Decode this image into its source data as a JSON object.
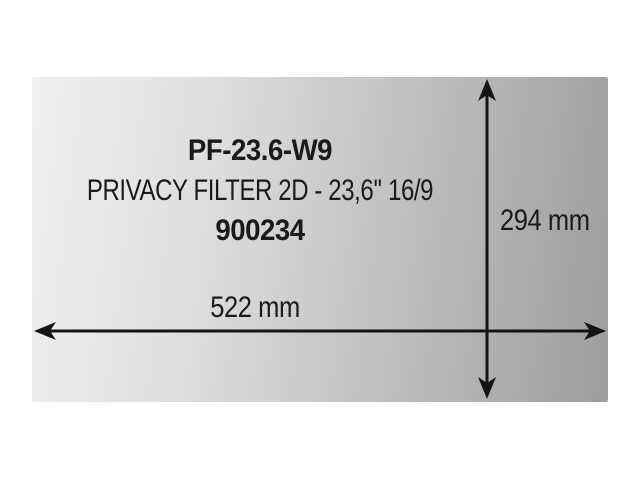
{
  "page": {
    "background": "#ffffff"
  },
  "panel": {
    "model": "PF-23.6-W9",
    "description": "PRIVACY FILTER 2D - 23,6'' 16/9",
    "sku": "900234",
    "colors": {
      "gradient_start": "#f0f0f0",
      "gradient_mid": "#c2c2c2",
      "gradient_end": "#9d9d9d",
      "text": "#1a1a1a",
      "arrow": "#141414"
    }
  },
  "dimensions": {
    "height_label": "294 mm",
    "width_label": "522 mm"
  }
}
